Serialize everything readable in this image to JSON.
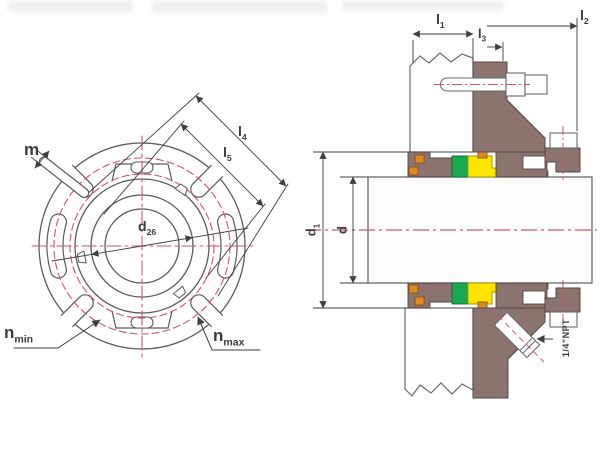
{
  "drawing": {
    "type": "mechanical-seal-technical-drawing",
    "colors": {
      "outline": "#5c5c5c",
      "dimension": "#3f3f3f",
      "centerline_red": "#cf5663",
      "body_brown": "#8b7370",
      "seal_green": "#1aa84f",
      "seal_yellow": "#ffe400",
      "oring_orange": "#dd8a21",
      "fill_white": "#ffffff"
    },
    "front_view": {
      "labels": {
        "m": {
          "base": "m",
          "sub": ""
        },
        "l4": {
          "base": "l",
          "sub": "4"
        },
        "l5": {
          "base": "l",
          "sub": "5"
        },
        "d26": {
          "base": "d",
          "sub": "26"
        },
        "n_min": {
          "base": "n",
          "sub": "min"
        },
        "n_max": {
          "base": "n",
          "sub": "max"
        }
      }
    },
    "section_view": {
      "labels": {
        "l1": {
          "base": "l",
          "sub": "1"
        },
        "l2": {
          "base": "l",
          "sub": "2"
        },
        "l3": {
          "base": "l",
          "sub": "3"
        },
        "d1": {
          "base": "d",
          "sub": "1"
        },
        "d": {
          "base": "d",
          "sub": ""
        },
        "npt": {
          "base": "1/4\"NPT",
          "sub": ""
        }
      }
    }
  }
}
